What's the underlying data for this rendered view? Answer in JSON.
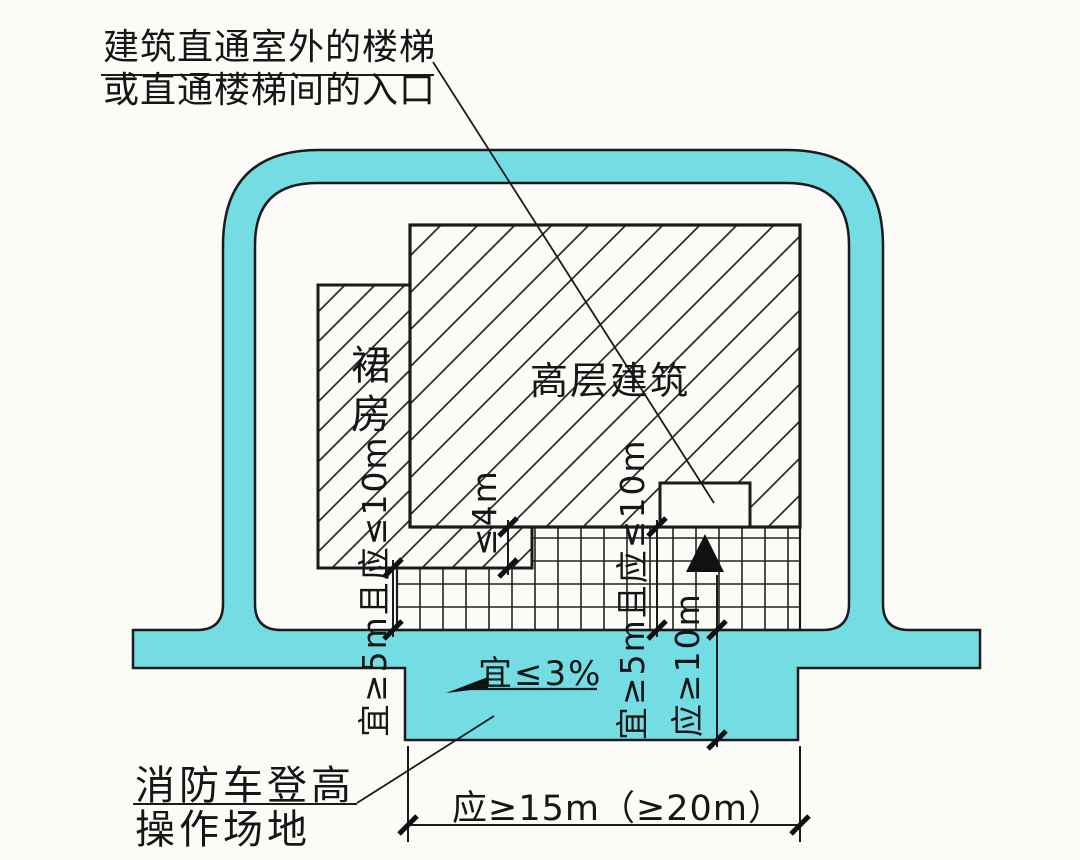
{
  "diagram": {
    "annotations": {
      "stair_entrance_note": {
        "line1": "建筑直通室外的楼梯",
        "line2": "或直通楼梯间的入口"
      },
      "fire_truck_site_note": {
        "line1": "消防车登高",
        "line2": "操作场地"
      },
      "slope_label": "宜≤3%"
    },
    "buildings": {
      "podium_label": "裙房",
      "highrise_label": "高层建筑"
    },
    "dimensions": {
      "building_to_site_left": "宜≥5m且应≤10m",
      "building_to_site_mid": "宜≥5m且应≤10m",
      "podium_depth": "≤4m",
      "site_depth": "应≥10m",
      "site_length": "应≥15m（≥20m）"
    },
    "colors": {
      "road_fill": "#74dde3",
      "outline": "#1b1b1b",
      "paper": "#fcfbf7"
    }
  }
}
